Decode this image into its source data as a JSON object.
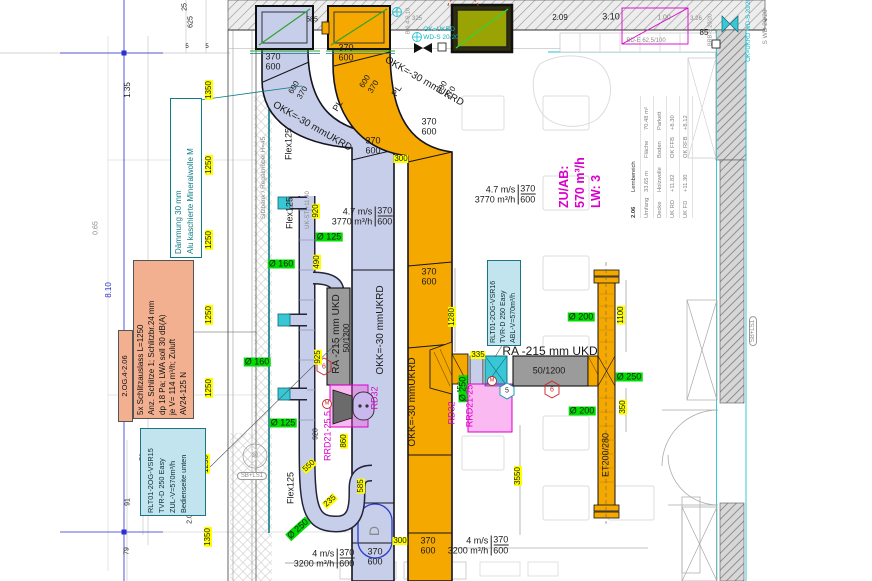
{
  "plan": {
    "duct_pair": {
      "w": "370",
      "h": "600"
    },
    "duct_pair_diag": {
      "a": "600",
      "b": "370"
    },
    "okk": "OKK=-30 mmUKRD",
    "pl": "PL",
    "flex": "Flex125",
    "ra": "RA -215 mm UKD",
    "silencer": "50/1200",
    "flow_supply_upper": {
      "v": "4.7 m/s",
      "q": "3770 m³/h",
      "w": "370",
      "h": "600"
    },
    "flow_supply_lower": {
      "v": "4 m/s",
      "q": "3200 m³/h",
      "w": "370",
      "h": "600"
    }
  },
  "annotations": {
    "slot_outlet": {
      "l1": "5x Schlitzauslass L=1250",
      "l2": "Anz. Schlitze 1; Schlitzbr.24 mm",
      "l3": "dp 18 Pa; LWA soll 30 dB(A)",
      "l4": "je V= 114 m³/h; Zuluft",
      "l5": "AV24-125 N"
    },
    "room_tag": "2.OG.4-2.06",
    "vsr15": {
      "l1": "RLT01-2OG-VSR15",
      "l2": "TVR-D 250 Easy",
      "l3": "ZUL-V=570m³/h",
      "l4": "Bedienseite unten"
    },
    "vsr16": {
      "l1": "RLT01-2OG-VSR16",
      "l2": "TVR-D 250 Easy",
      "l3": "ABL-V=570m³/h"
    },
    "daemmung": {
      "l1": "Dämmung 30 mm",
      "l2": "Alu kaschierte Mineralwolle M"
    },
    "zuab": {
      "l1": "ZU/AB:",
      "l2": "570 m³/h",
      "l3": "LW: 3"
    },
    "sitzbank": "Sitzbank / Regalmöbel H=45",
    "uk_st": "UK-ST +11.40",
    "ok_ukrd_l1": "OK=UKRD",
    "ok_ukrd_l2": "WD-S 20/20",
    "ok_ukrd_right": "OK=UKRD WD-S 20/20",
    "s_wd": "S WD 20/20",
    "brb": "BRB-S 20/20",
    "bd_e": "BD-E 62,5/100",
    "b04": "B-0.4-S.10",
    "et": "ET200/280",
    "sb_ls1": "SB+LS1",
    "rd32": "RD32",
    "rrd21_255": "RRD21-25.5",
    "rrd21_25": "RRD21-25"
  },
  "room_stamp": {
    "number": "2.06",
    "name": "Lernbereich",
    "r1l": "Umfang",
    "r1v": "33.65 m",
    "r1l2": "Fläche",
    "r1v2": "70.48 m²",
    "r2l": "Decke",
    "r2v": "Holzwolle",
    "r2l2": "Boden",
    "r2v2": "Parkett",
    "r3l": "UK RD",
    "r3v": "+11.82",
    "r3l2": "OK FFB",
    "r3v2": "+8.30",
    "r4l": "UK FD",
    "r4v": "+11.30",
    "r4l2": "OK RFB",
    "r4v2": "+8.12"
  },
  "dims": {
    "yellow": [
      "1350",
      "1250",
      "1250",
      "1250",
      "1250",
      "1250",
      "1350",
      "300",
      "920",
      "490",
      "925",
      "550",
      "235",
      "585",
      "860",
      "1280",
      "335",
      "1100",
      "350",
      "3550",
      "300"
    ],
    "green": [
      "Ø 125",
      "Ø 160",
      "Ø 160",
      "Ø 125",
      "Ø 250",
      "Ø 250",
      "Ø 200",
      "Ø 250",
      "Ø 200"
    ],
    "black": [
      "585",
      "2.09",
      "3.10",
      "1.00",
      "3.26",
      "85",
      "325",
      "25",
      "625",
      "5",
      "5",
      "1.35",
      "0.65",
      "79",
      "91",
      "91",
      "79",
      "2.01",
      "920",
      "8.10",
      "45°"
    ]
  },
  "markers": {
    "hex_a": "6",
    "hex_b": "6",
    "pentagon": "5",
    "motor": "M",
    "circle30": "30",
    "d_tag": "D"
  }
}
